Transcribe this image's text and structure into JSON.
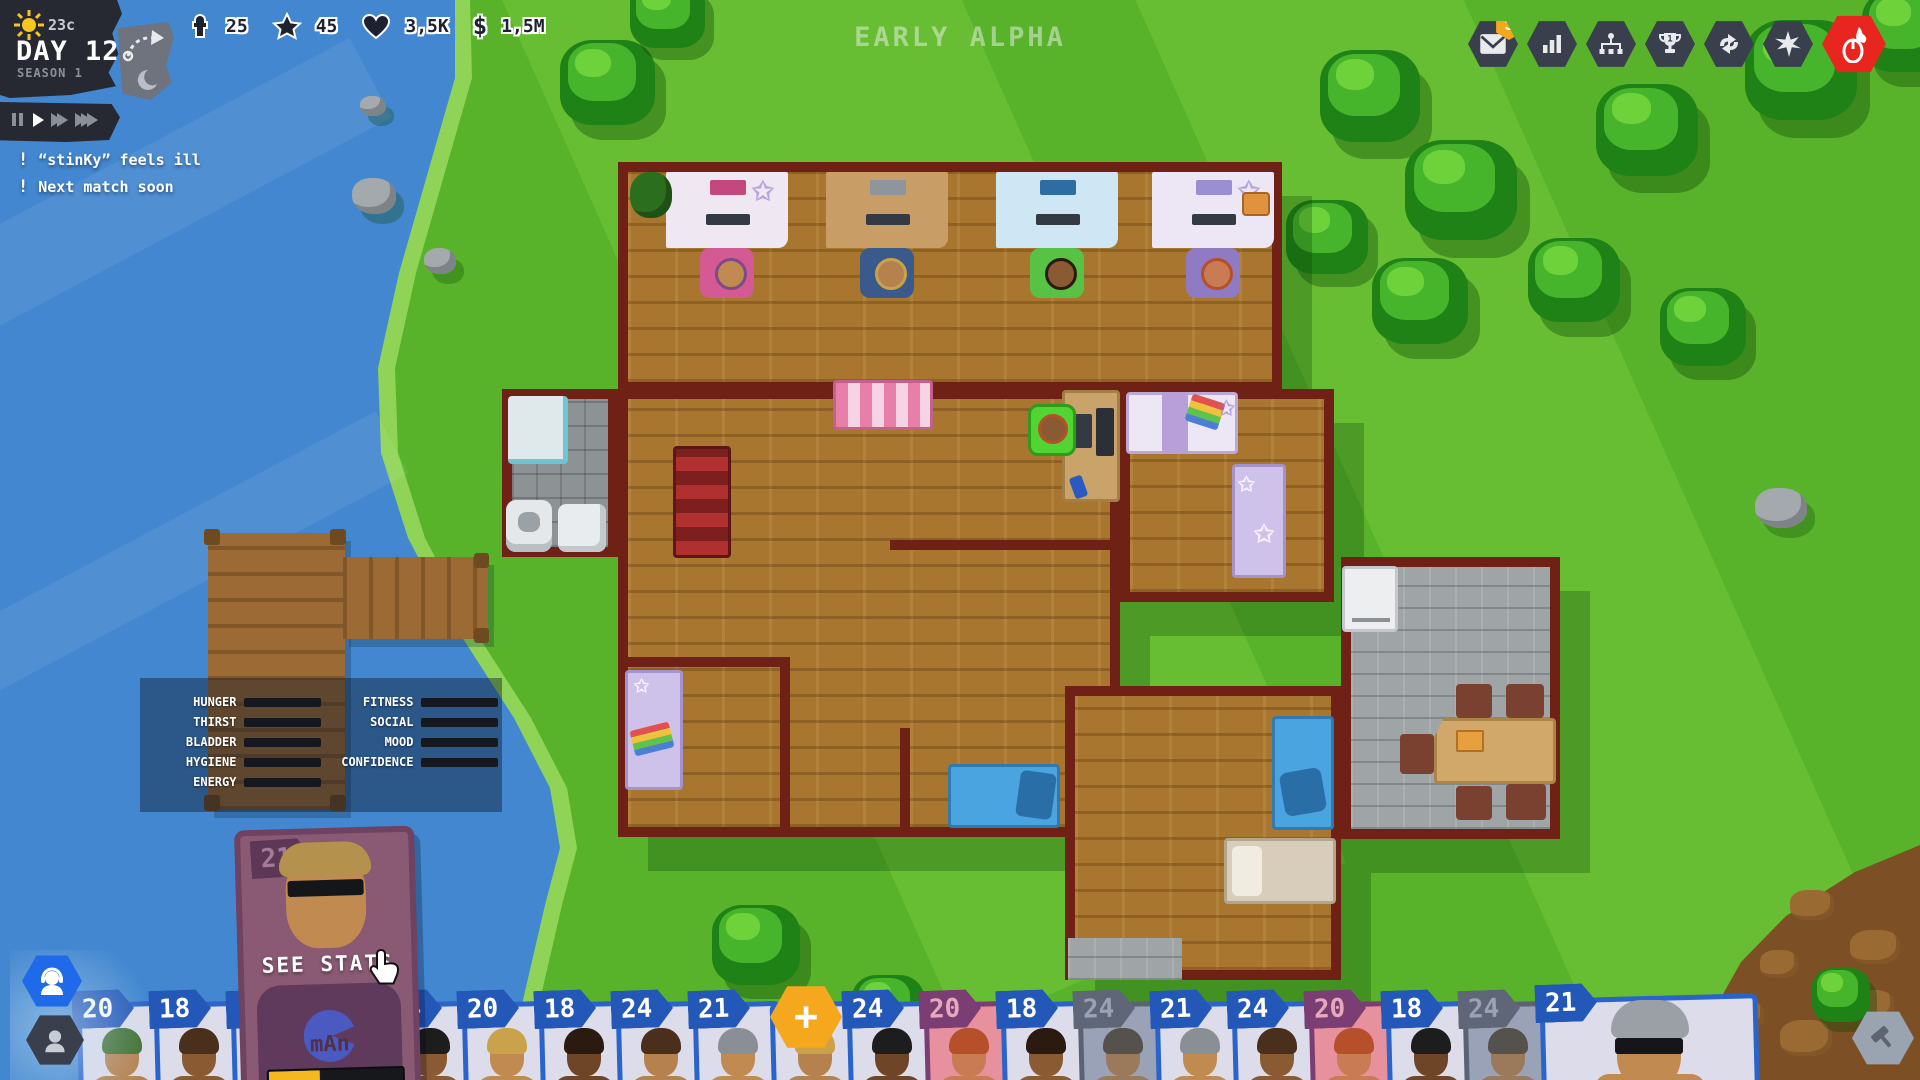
{
  "hud": {
    "weather_temp": "23c",
    "day_label": "DAY 12",
    "season_label": "SEASON 1",
    "alpha_banner": "EARLY ALPHA",
    "resources": [
      {
        "name": "players",
        "icon": "person-icon",
        "value": "25"
      },
      {
        "name": "fans",
        "icon": "star-icon",
        "value": "45"
      },
      {
        "name": "hearts",
        "icon": "heart-icon",
        "value": "3,5K"
      },
      {
        "name": "money",
        "icon": "dollar-icon",
        "value": "1,5M"
      }
    ],
    "playback": {
      "active": "play",
      "buttons": [
        "pause",
        "play",
        "fast-forward",
        "fastest"
      ]
    },
    "notifications": [
      {
        "text": "“stinKy” feels ill"
      },
      {
        "text": "Next match soon"
      }
    ],
    "topbar": [
      {
        "name": "mail",
        "icon": "mail-icon",
        "badge": "3"
      },
      {
        "name": "stats",
        "icon": "bar-chart-icon"
      },
      {
        "name": "management",
        "icon": "org-chart-icon"
      },
      {
        "name": "tournament",
        "icon": "trophy-icon",
        "trophy_number": "1"
      },
      {
        "name": "transfers",
        "icon": "swap-arrows-icon"
      },
      {
        "name": "events",
        "icon": "burst-icon"
      },
      {
        "name": "play-match",
        "icon": "fire-mouse-icon",
        "color": "#e8261f"
      }
    ]
  },
  "stats_panel": {
    "left": [
      {
        "label": "HUNGER",
        "value": 40
      },
      {
        "label": "THIRST",
        "value": 100
      },
      {
        "label": "BLADDER",
        "value": 62
      },
      {
        "label": "HYGIENE",
        "value": 35
      },
      {
        "label": "ENERGY",
        "value": 67
      }
    ],
    "right": [
      {
        "label": "FITNESS",
        "value": 65
      },
      {
        "label": "SOCIAL",
        "value": 48
      },
      {
        "label": "MOOD",
        "value": 35
      },
      {
        "label": "CONFIDENCE",
        "value": 13
      }
    ]
  },
  "selected_card": {
    "number": "21",
    "hover_label": "SEE STATS",
    "name": "mAn",
    "progress": 38
  },
  "add_player_label": "+",
  "roster": [
    {
      "number": "20",
      "variant": "blue",
      "hair": "#3f7030",
      "skin": "#b5824e"
    },
    {
      "number": "18",
      "variant": "blue",
      "hair": "#4a2f1d",
      "skin": "#8a5a32"
    },
    {
      "number": "",
      "variant": "blue",
      "hair": "#2a1a10",
      "skin": "#6e4526"
    },
    {
      "number": "",
      "variant": "blue",
      "hair": "#caa24a",
      "skin": "#c08a50"
    },
    {
      "number": "24",
      "variant": "blue",
      "hair": "#1d1d1d",
      "skin": "#8a5a32"
    },
    {
      "number": "20",
      "variant": "blue",
      "hair": "#caa24a",
      "skin": "#c08a50"
    },
    {
      "number": "18",
      "variant": "blue",
      "hair": "#2a1a10",
      "skin": "#6e4526"
    },
    {
      "number": "24",
      "variant": "blue",
      "hair": "#4a2f1d",
      "skin": "#b5824e"
    },
    {
      "number": "21",
      "variant": "blue",
      "hair": "#8a8f96",
      "skin": "#c08a50"
    },
    {
      "number": "",
      "variant": "blue",
      "hair": "#caa24a",
      "skin": "#b5824e"
    },
    {
      "number": "24",
      "variant": "blue",
      "hair": "#1d1d1d",
      "skin": "#6e4526"
    },
    {
      "number": "20",
      "variant": "pink",
      "hair": "#b5502a",
      "skin": "#c97b54"
    },
    {
      "number": "18",
      "variant": "blue",
      "hair": "#2a1a10",
      "skin": "#8a5a32"
    },
    {
      "number": "24",
      "variant": "gray",
      "hair": "#55524e",
      "skin": "#9a7a5a"
    },
    {
      "number": "21",
      "variant": "blue",
      "hair": "#8a8f96",
      "skin": "#c08a50"
    },
    {
      "number": "24",
      "variant": "blue",
      "hair": "#4a2f1d",
      "skin": "#8a5a32"
    },
    {
      "number": "20",
      "variant": "pink",
      "hair": "#b5502a",
      "skin": "#c97b54"
    },
    {
      "number": "18",
      "variant": "blue",
      "hair": "#1d1d1d",
      "skin": "#6e4526"
    },
    {
      "number": "24",
      "variant": "gray",
      "hair": "#55524e",
      "skin": "#9a7a5a"
    },
    {
      "number": "21",
      "variant": "blue",
      "hair": "#9aa0a6",
      "skin": "#c08a50"
    }
  ],
  "side_buttons": [
    {
      "name": "players-filter",
      "icon": "headset-person-icon",
      "active": true
    },
    {
      "name": "staff-filter",
      "icon": "person-icon",
      "active": false
    }
  ],
  "build_button": {
    "name": "build",
    "icon": "hammer-icon"
  }
}
